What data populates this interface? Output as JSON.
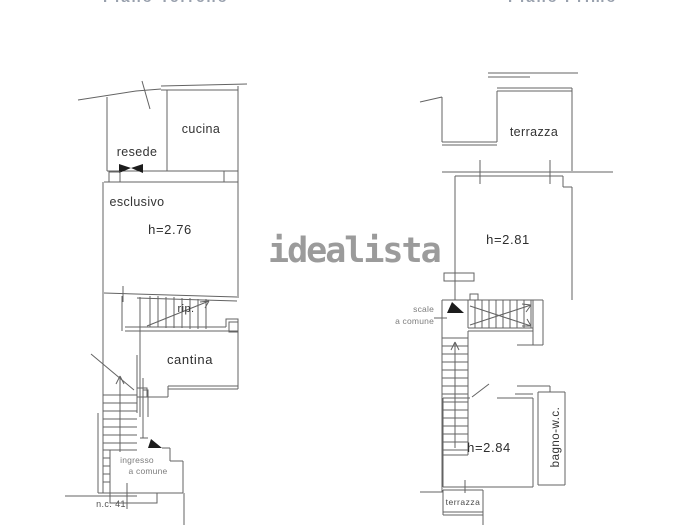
{
  "watermark": {
    "text": "idealista"
  },
  "page_titles": {
    "left_partial": "Piano Terreno",
    "right_partial": "Piano Primo"
  },
  "left_plan": {
    "resede": {
      "line1": "resede",
      "line2": "esclusivo"
    },
    "cucina": "cucina",
    "main_height": "h=2.76",
    "rip": "rip.",
    "cantina": "cantina",
    "ingresso": {
      "line1": "ingresso",
      "line2": "a comune"
    },
    "civic_number": "n.c. 41"
  },
  "right_plan": {
    "terrace_top": "terrazza",
    "main_height": "h=2.81",
    "stairs": {
      "line1": "scale",
      "line2": "a comune"
    },
    "lower_height": "h=2.84",
    "bathroom": "bagno-w.c.",
    "terrace_bottom": "terrazza"
  },
  "colors": {
    "walls": "#636363",
    "labels": "#333333",
    "muted_labels": "#7d7d7d",
    "watermark": "#9b9b9b",
    "background": "#ffffff"
  }
}
